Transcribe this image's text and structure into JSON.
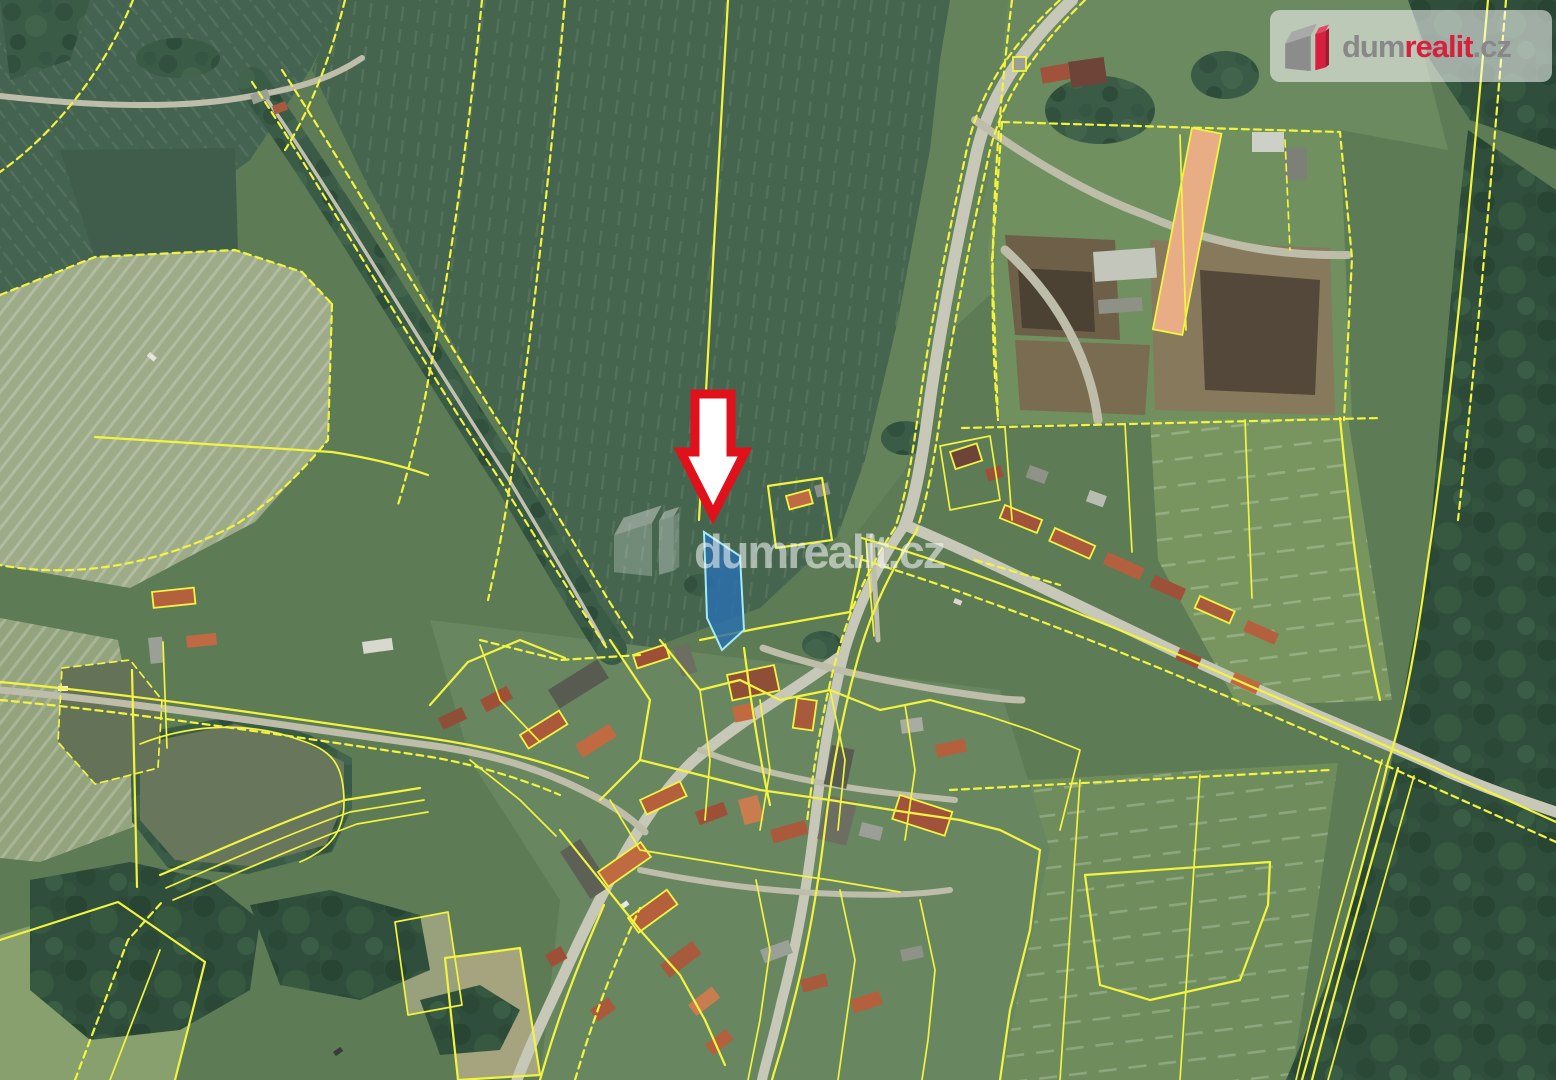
{
  "branding": {
    "watermark_text": "dumrealit.cz",
    "logo_text": {
      "prefix": "dum",
      "emphasis": "realit",
      "suffix": ".cz"
    }
  },
  "map": {
    "kind": "aerial-cadastral-map",
    "marker_shape": "down-arrow",
    "highlight": "blue-parcel"
  },
  "colors": {
    "brand_red": "#d81f3e",
    "logo_gray": "#888888",
    "parcel_line": "#f2f440",
    "parcel_highlight_fill": "#2a6fb0",
    "parcel_highlight_stroke": "#a6ebf4",
    "marker_fill": "#ffffff",
    "marker_stroke": "#e0111a"
  }
}
